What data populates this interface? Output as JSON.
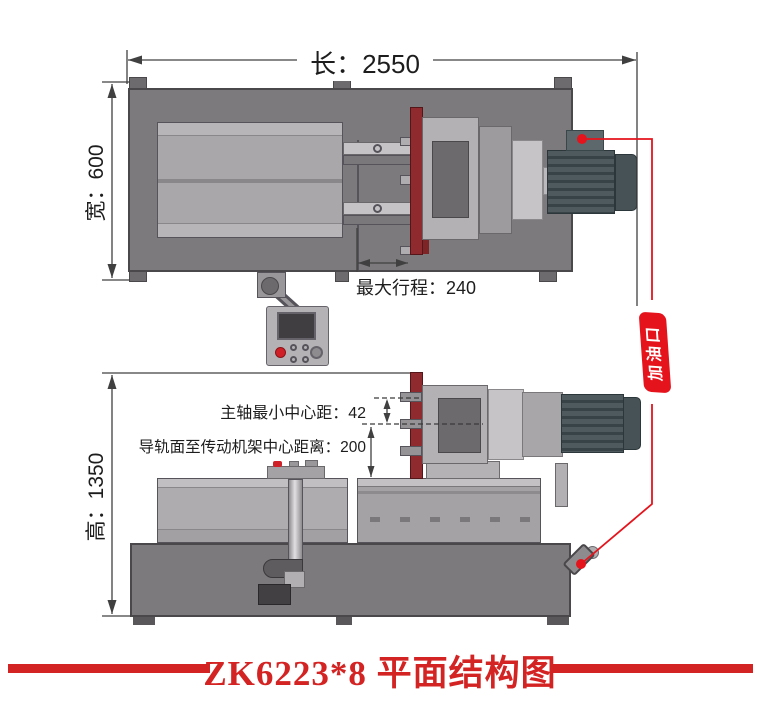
{
  "caption": {
    "title": "ZK6223*8 平面结构图"
  },
  "dimensions": {
    "length": "长：2550",
    "width": "宽：600",
    "height": "高：1350",
    "max_stroke": "最大行程：240",
    "spindle_min_center_distance": "主轴最小中心距：42",
    "rail_to_frame_center_distance": "导轨面至传动机架中心距离：200"
  },
  "callouts": {
    "oil_filler_port": "加油口"
  },
  "palette": {
    "title_red": "#d32322",
    "callout_red": "#e5131c",
    "faceplate_red": "#8f2b2e",
    "machine_body_grey": "#7d7a7d",
    "panel_grey": "#aaa7aa",
    "motor_grey": "#4e5a5e",
    "dimension_line": "#404040",
    "background": "#ffffff"
  }
}
